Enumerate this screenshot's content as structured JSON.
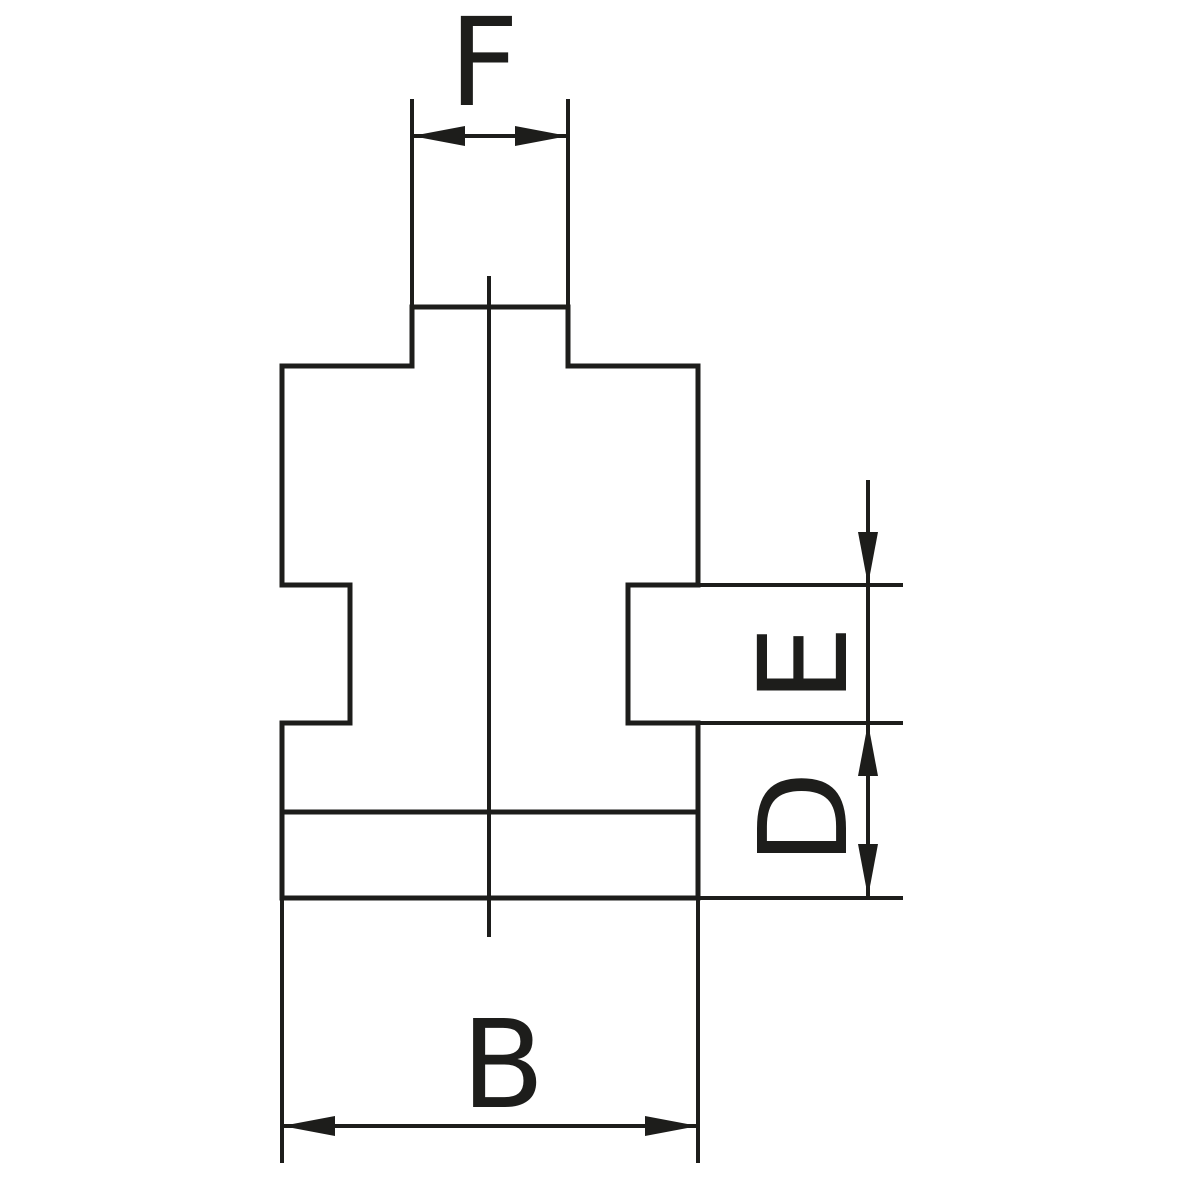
{
  "page": {
    "background_color": "#ffffff"
  },
  "figure": {
    "type": "technical-drawing",
    "stroke_color": "#1d1d1b",
    "canvas": {
      "width": 1200,
      "height": 1200
    },
    "line_widths": {
      "outline": 5,
      "thin": 4
    },
    "font_size": 122,
    "label_baseline_offset": 44,
    "labels": {
      "top_width": "F",
      "right_upper": "E",
      "right_lower": "D",
      "bottom_width": "B"
    },
    "label_layout": [
      {
        "key": "top_width",
        "x": 484,
        "y": 61,
        "rotation": 0
      },
      {
        "key": "right_upper",
        "x": 802,
        "y": 664,
        "rotation": -90
      },
      {
        "key": "right_lower",
        "x": 802,
        "y": 818,
        "rotation": -90
      },
      {
        "key": "bottom_width",
        "x": 503,
        "y": 1063,
        "rotation": 0
      }
    ],
    "outline_segments": [
      {
        "name": "tenon-top-edge",
        "x1": 412,
        "y1": 307,
        "x2": 568,
        "y2": 307
      },
      {
        "name": "tenon-left-edge",
        "x1": 412,
        "y1": 307,
        "x2": 412,
        "y2": 366
      },
      {
        "name": "tenon-right-edge",
        "x1": 568,
        "y1": 307,
        "x2": 568,
        "y2": 366
      },
      {
        "name": "left-shoulder",
        "x1": 282,
        "y1": 366,
        "x2": 412,
        "y2": 366
      },
      {
        "name": "right-shoulder",
        "x1": 568,
        "y1": 366,
        "x2": 698,
        "y2": 366
      },
      {
        "name": "body-left-edge-upper",
        "x1": 282,
        "y1": 366,
        "x2": 282,
        "y2": 585
      },
      {
        "name": "body-right-edge-upper",
        "x1": 698,
        "y1": 366,
        "x2": 698,
        "y2": 585
      },
      {
        "name": "left-groove-top",
        "x1": 282,
        "y1": 585,
        "x2": 350,
        "y2": 585
      },
      {
        "name": "left-groove-floor",
        "x1": 350,
        "y1": 585,
        "x2": 350,
        "y2": 723
      },
      {
        "name": "left-groove-bottom",
        "x1": 282,
        "y1": 723,
        "x2": 350,
        "y2": 723
      },
      {
        "name": "body-left-edge-lower",
        "x1": 282,
        "y1": 723,
        "x2": 282,
        "y2": 898
      },
      {
        "name": "right-groove-top",
        "x1": 628,
        "y1": 585,
        "x2": 698,
        "y2": 585
      },
      {
        "name": "right-groove-floor",
        "x1": 628,
        "y1": 585,
        "x2": 628,
        "y2": 723
      },
      {
        "name": "right-groove-bottom",
        "x1": 628,
        "y1": 723,
        "x2": 698,
        "y2": 723
      },
      {
        "name": "body-right-edge-lower",
        "x1": 698,
        "y1": 723,
        "x2": 698,
        "y2": 898
      },
      {
        "name": "body-step-line",
        "x1": 282,
        "y1": 812,
        "x2": 698,
        "y2": 812
      },
      {
        "name": "body-bottom-edge",
        "x1": 282,
        "y1": 898,
        "x2": 698,
        "y2": 898
      }
    ],
    "thin_segments": [
      {
        "name": "f-extension-left",
        "x1": 412,
        "y1": 99,
        "x2": 412,
        "y2": 307
      },
      {
        "name": "f-extension-right",
        "x1": 568,
        "y1": 99,
        "x2": 568,
        "y2": 307
      },
      {
        "name": "f-dimension-line",
        "x1": 412,
        "y1": 136,
        "x2": 568,
        "y2": 136
      },
      {
        "name": "e-extension-top",
        "x1": 698,
        "y1": 585,
        "x2": 903,
        "y2": 585
      },
      {
        "name": "ed-extension-middle",
        "x1": 698,
        "y1": 723,
        "x2": 903,
        "y2": 723
      },
      {
        "name": "d-extension-bottom",
        "x1": 698,
        "y1": 898,
        "x2": 903,
        "y2": 898
      },
      {
        "name": "ed-dimension-line",
        "x1": 868,
        "y1": 480,
        "x2": 868,
        "y2": 897
      },
      {
        "name": "b-extension-left",
        "x1": 282,
        "y1": 898,
        "x2": 282,
        "y2": 1163
      },
      {
        "name": "b-extension-right",
        "x1": 698,
        "y1": 898,
        "x2": 698,
        "y2": 1163
      },
      {
        "name": "b-dimension-line",
        "x1": 282,
        "y1": 1126,
        "x2": 698,
        "y2": 1126
      },
      {
        "name": "vertical-centerline",
        "x1": 489,
        "y1": 276,
        "x2": 489,
        "y2": 937
      }
    ],
    "arrowheads": [
      {
        "name": "f-arrow-left",
        "points": [
          [
            412,
            136
          ],
          [
            465,
            126
          ],
          [
            465,
            146
          ]
        ]
      },
      {
        "name": "f-arrow-right",
        "points": [
          [
            568,
            136
          ],
          [
            515,
            126
          ],
          [
            515,
            146
          ]
        ]
      },
      {
        "name": "e-arrow-down",
        "points": [
          [
            868,
            585
          ],
          [
            858,
            532
          ],
          [
            878,
            532
          ]
        ]
      },
      {
        "name": "ed-arrow-up",
        "points": [
          [
            868,
            723
          ],
          [
            858,
            776
          ],
          [
            878,
            776
          ]
        ]
      },
      {
        "name": "d-arrow-down",
        "points": [
          [
            868,
            897
          ],
          [
            858,
            844
          ],
          [
            878,
            844
          ]
        ]
      },
      {
        "name": "b-arrow-left",
        "points": [
          [
            282,
            1126
          ],
          [
            335,
            1116
          ],
          [
            335,
            1136
          ]
        ]
      },
      {
        "name": "b-arrow-right",
        "points": [
          [
            698,
            1126
          ],
          [
            645,
            1116
          ],
          [
            645,
            1136
          ]
        ]
      }
    ]
  }
}
